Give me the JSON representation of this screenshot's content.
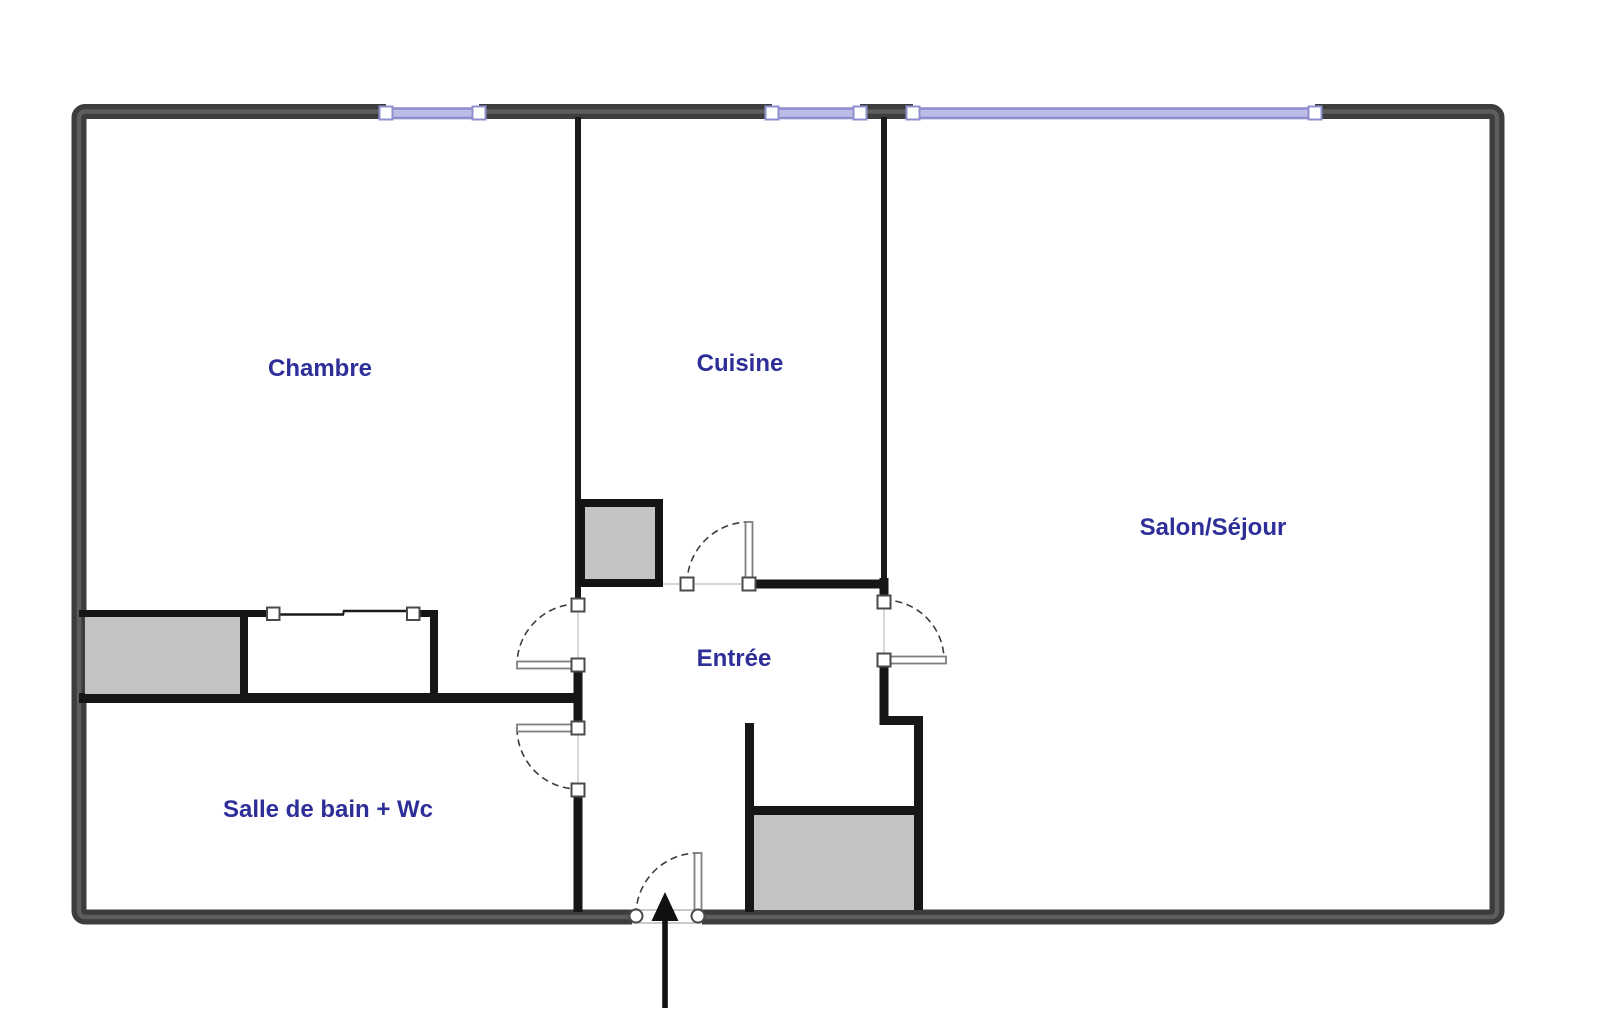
{
  "floorplan": {
    "type": "apartment-floor-plan",
    "rooms": [
      {
        "name": "chambre",
        "label": "Chambre"
      },
      {
        "name": "cuisine",
        "label": "Cuisine"
      },
      {
        "name": "salon_sejour",
        "label": "Salon/Séjour"
      },
      {
        "name": "entree",
        "label": "Entrée"
      },
      {
        "name": "salle_de_bain_wc",
        "label": "Salle de bain + Wc"
      }
    ],
    "windows": {
      "count": 3,
      "wall": "top"
    },
    "doors": {
      "count": 5,
      "entrance_arrow": true
    },
    "fixtures": {
      "count": 3
    },
    "colors": {
      "background": "#ffffff",
      "outer_wall": "#3d3d3d",
      "outer_wall_core": "#5d5d5d",
      "interior_wall": "#161616",
      "window_accent": "#8f8fcf",
      "window_fill": "#bcbce6",
      "fixture_fill": "#c3c3c3",
      "door_leaf_stroke": "#7f7f7f",
      "opening_line": "#d8d8d8",
      "room_label": "#2e2e99"
    }
  }
}
